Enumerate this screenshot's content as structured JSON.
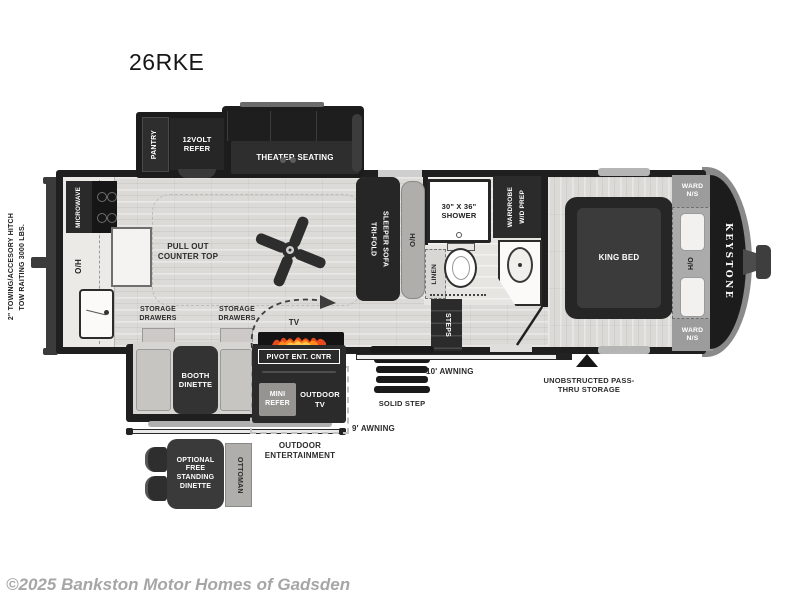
{
  "page": {
    "title": "26RKE",
    "copyright": "©2025 Bankston Motor Homes of Gadsden"
  },
  "exterior": {
    "brand": "KEYSTONE",
    "tow_line1": "2\" TOWING/ACCESORY HITCH",
    "tow_line2": "TOW RAITING 3000 LBS.",
    "awning_rear": "9' AWNING",
    "awning_main": "10' AWNING",
    "passthru": "UNOBSTRUCTED PASS-THRU STORAGE",
    "solid_step": "SOLID STEP",
    "outdoor_entertainment": "OUTDOOR ENTERTAINMENT",
    "outdoor_tv": "OUTDOOR TV",
    "mini_refer": "MINI REFER"
  },
  "kitchen": {
    "microwave": "MICROWAVE",
    "overhead": "O/H",
    "pull_out_counter": "PULL OUT COUNTER TOP",
    "storage_drawers_left": "STORAGE DRAWERS",
    "storage_drawers_right": "STORAGE DRAWERS",
    "pantry": "PANTRY",
    "refer": "12VOLT REFER"
  },
  "living": {
    "theater_seating": "THEATER SEATING",
    "sofa_line1": "TRI-FOLD",
    "sofa_line2": "SLEEPER SOFA",
    "sofa_overhead": "O/H",
    "tv": "TV",
    "pivot_ent_cntr": "PIVOT ENT. CNTR",
    "booth_dinette": "BOOTH DINETTE",
    "optional_dinette": "OPTIONAL FREE STANDING DINETTE",
    "ottoman": "OTTOMAN"
  },
  "bath": {
    "shower": "30\" X 36\" SHOWER",
    "wardrobe_line1": "WARDROBE",
    "wardrobe_line2": "W/D PREP",
    "linen": "LINEN",
    "steps": "STEPS"
  },
  "bedroom": {
    "king_bed": "KING BED",
    "ward_top": "WARD N/S",
    "ward_bottom": "WARD N/S",
    "overhead": "H/O"
  }
}
